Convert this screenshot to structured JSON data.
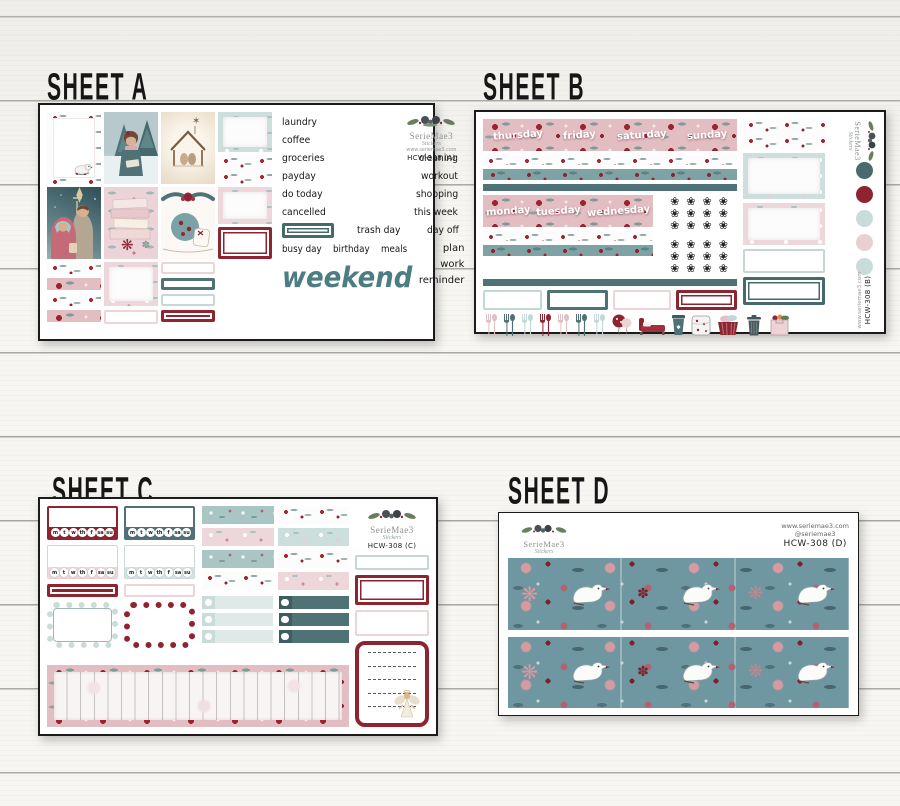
{
  "brand": {
    "name": "SerieMae3",
    "tagline": "Stickers",
    "website": "www.seriemae3.com",
    "handle": "@seriemae3"
  },
  "glyphs": {
    "florette": "❀",
    "poinsettia": "❋",
    "sparkle": "✽",
    "star": "✶"
  },
  "palette": {
    "dark_teal": "#4a6b6d",
    "dark_red": "#8e2430",
    "light_blue": "#c9dcda",
    "blush_pink": "#e8cfd2",
    "washi_pink": "#e2bdc2",
    "script_teal": "#4b7d83",
    "strip_teal": "#6e97a1"
  },
  "sheets": {
    "a": {
      "title": "SHEET A",
      "code": "HCW-308 (A)",
      "labels": [
        "laundry",
        "coffee",
        "groceries",
        "cleaning",
        "payday",
        "workout",
        "do today",
        "shopping",
        "cancelled",
        "this week",
        "trash day",
        "day off",
        "busy day",
        "birthday",
        "meals",
        "plan",
        "work",
        "reminder"
      ],
      "weekend": "weekend"
    },
    "b": {
      "title": "SHEET B",
      "code": "HCW-308 (B)",
      "days_top": [
        "thursday",
        "friday",
        "saturday",
        "sunday"
      ],
      "days_bottom": [
        "monday",
        "tuesday",
        "wednesday"
      ],
      "swatches": [
        "#4a6b6d",
        "#8e2430",
        "#c9dcda",
        "#e8cfd2",
        "#c9dcda"
      ],
      "icons": [
        "utensils-pink",
        "utensils-teal",
        "utensils-light-blue",
        "utensils-red",
        "utensils-pink",
        "utensils-teal",
        "utensils-light-blue",
        "balloon",
        "bed",
        "coffee-cup",
        "blanket",
        "laundry-basket",
        "trash-can",
        "grocery-bag"
      ]
    },
    "c": {
      "title": "SHEET C",
      "code": "HCW-308 (C)",
      "week_letters": [
        "m",
        "t",
        "w",
        "th",
        "f",
        "sa",
        "su"
      ]
    },
    "d": {
      "title": "SHEET D",
      "code": "HCW-308 (D)"
    }
  }
}
